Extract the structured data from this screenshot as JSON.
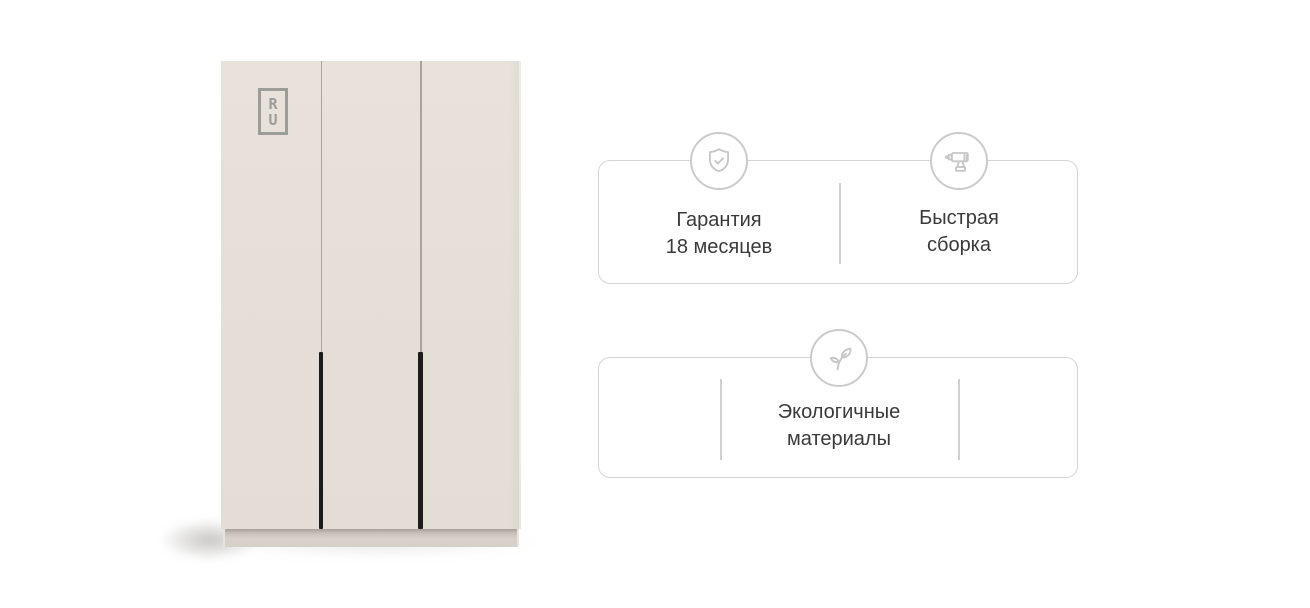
{
  "page": {
    "background": "#ffffff"
  },
  "product_image": {
    "logo_lines": [
      "R",
      "U"
    ],
    "colors": {
      "door": "#e4ded6",
      "door_seam": "#a9a39c",
      "handle": "#1c1c1c",
      "base": "#d5cfc7",
      "logo": "#9c9c98"
    }
  },
  "feature_cards": [
    {
      "items": [
        {
          "icon": "shield-check-icon",
          "lines": [
            "Гарантия",
            "18 месяцев"
          ]
        },
        {
          "icon": "drill-icon",
          "lines": [
            "Быстрая",
            "сборка"
          ]
        }
      ]
    },
    {
      "items": [
        {
          "icon": "leaf-icon",
          "lines": [
            "Экологичные",
            "материалы"
          ]
        }
      ]
    }
  ],
  "style_tokens": {
    "card_border": "#d5d5d5",
    "icon_circle_border": "#cbcbcb",
    "icon_stroke": "#c7c7c7",
    "divider": "#d0d0d0",
    "text": "#3a3a3a"
  }
}
